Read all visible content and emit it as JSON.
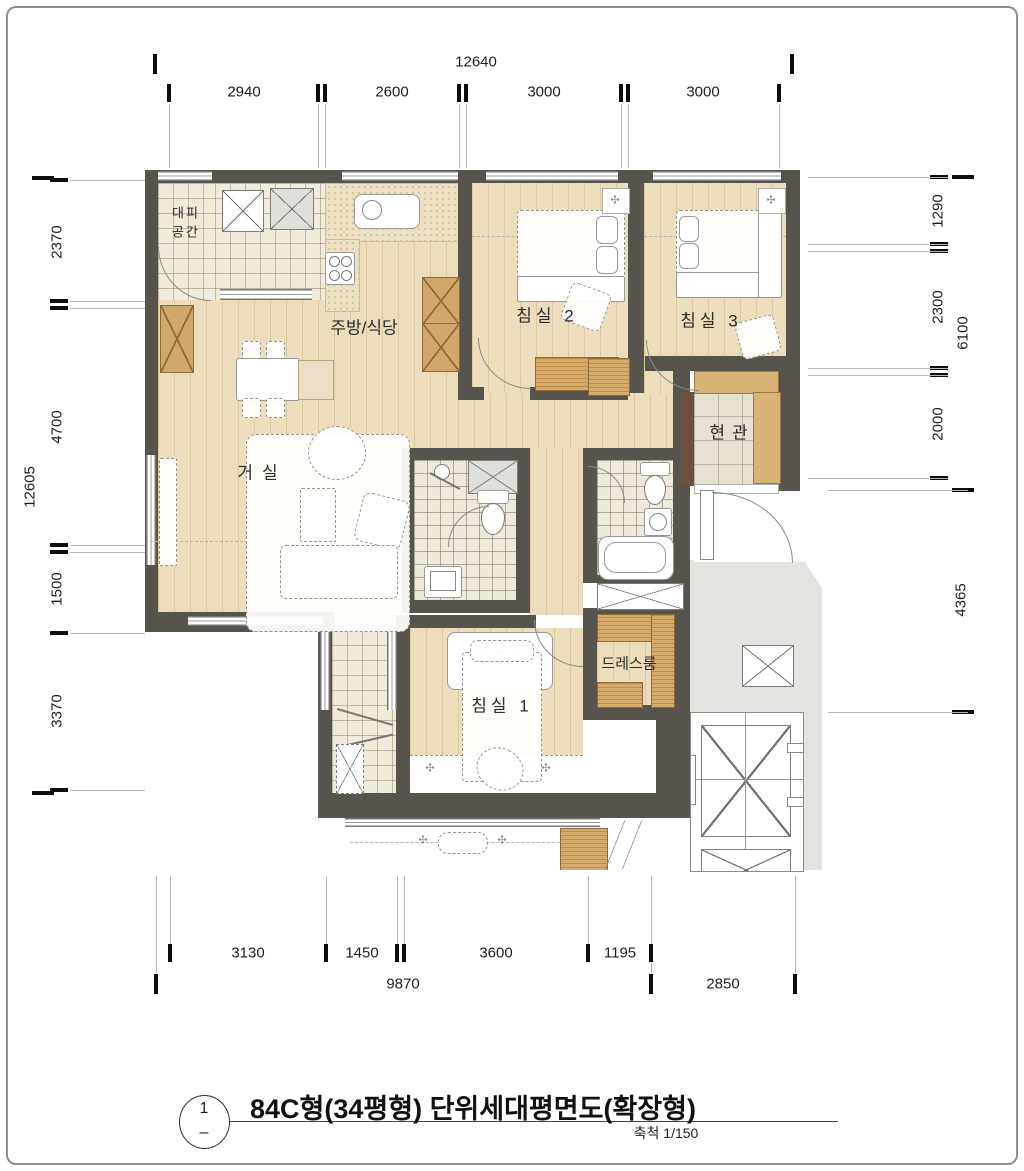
{
  "dims": {
    "top": {
      "overall": "12640",
      "segments": [
        "2940",
        "2600",
        "3000",
        "3000"
      ]
    },
    "left": {
      "overall": "12605",
      "segments": [
        "2370",
        "4700",
        "1500",
        "3370"
      ]
    },
    "right": {
      "segments": [
        "1290",
        "2300",
        "2000"
      ],
      "group": "6100",
      "lower": "4365"
    },
    "bottom": {
      "segments": [
        "3130",
        "1450",
        "3600",
        "1195"
      ],
      "overall": "9870",
      "side": "2850"
    }
  },
  "rooms": {
    "evac1": "대피",
    "evac2": "공간",
    "kitchen": "주방/식당",
    "bed2": "침실 2",
    "bed3": "침실 3",
    "living": "거실",
    "entry": "현관",
    "dress": "드레스룸",
    "bed1": "침실 1"
  },
  "title_block": {
    "num": "1",
    "dash": "–",
    "title": "84C형(34평형) 단위세대평면도(확장형)",
    "scale": "축척 1/150"
  },
  "icons": {
    "vent": "✣"
  },
  "colors": {
    "wall": "#57534D",
    "wood_floor": "#ECDEBC",
    "tile_floor": "#F1EBDC",
    "common_gray": "#E3E3E0",
    "cabinet_wood": "#D2A76B",
    "accent_brown": "#6D5140"
  }
}
